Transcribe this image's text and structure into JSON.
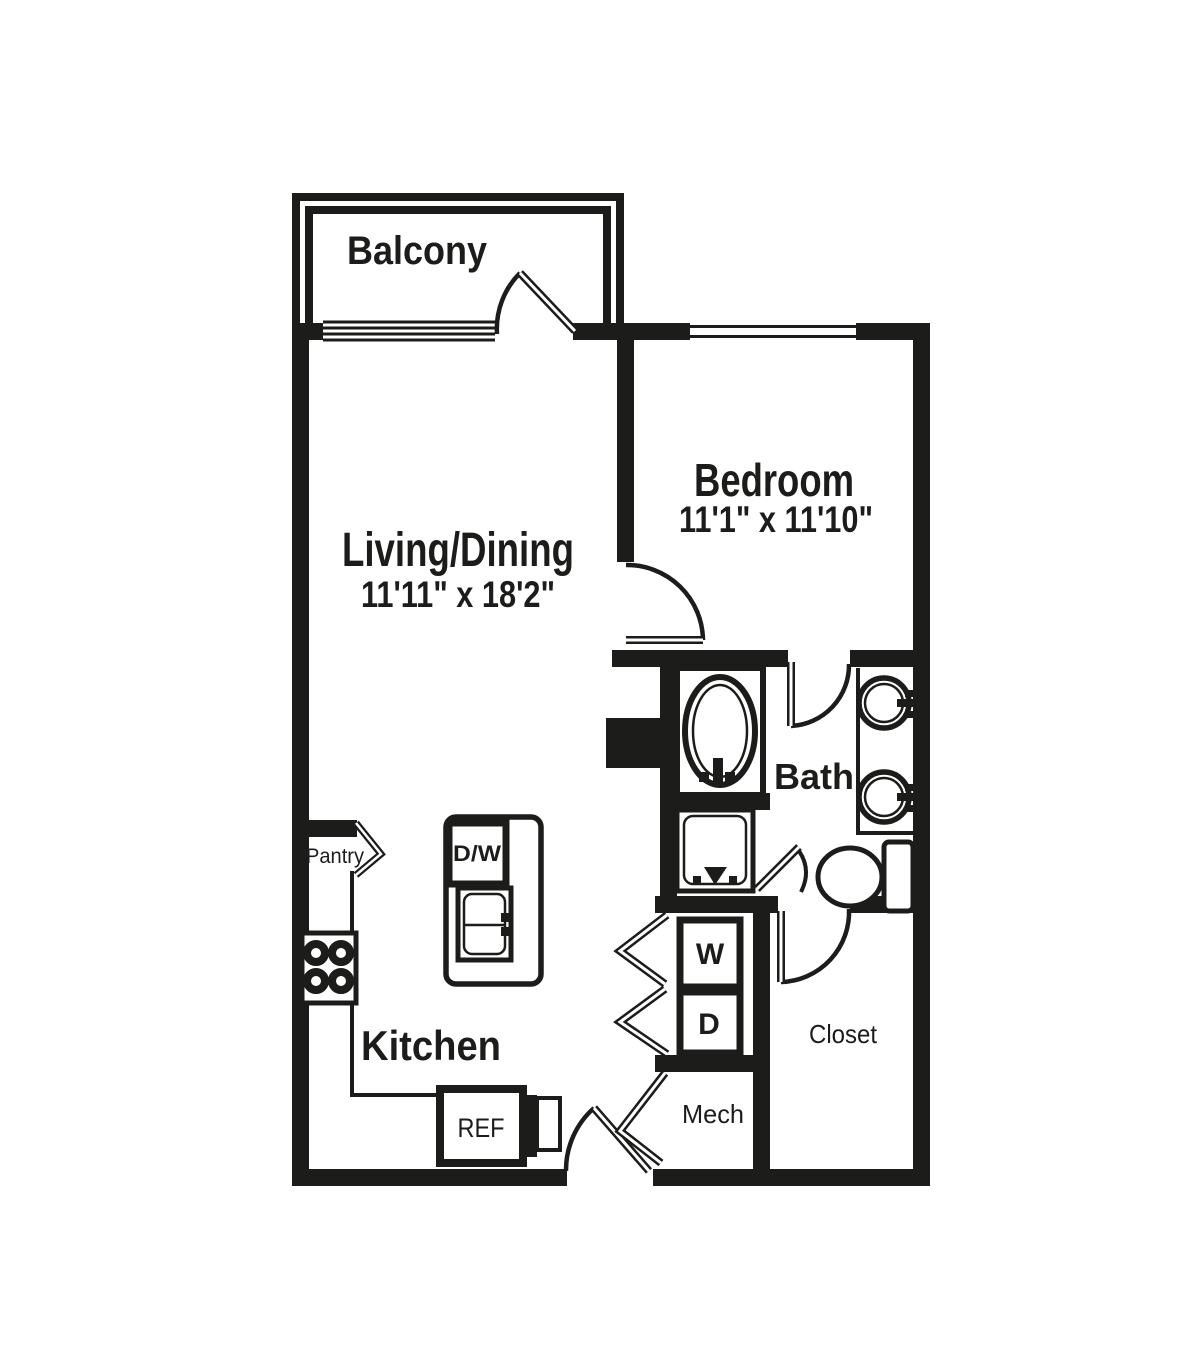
{
  "plan": {
    "rooms": {
      "balcony": {
        "label": "Balcony"
      },
      "living_dining": {
        "label": "Living/Dining",
        "dimensions": "11'11\" x 18'2\""
      },
      "bedroom": {
        "label": "Bedroom",
        "dimensions": "11'1\" x 11'10\""
      },
      "bath": {
        "label": "Bath"
      },
      "kitchen": {
        "label": "Kitchen"
      },
      "pantry": {
        "label": "Pantry"
      },
      "closet": {
        "label": "Closet"
      },
      "mech": {
        "label": "Mech"
      }
    },
    "appliances": {
      "dishwasher": {
        "label": "D/W"
      },
      "refrigerator": {
        "label": "REF"
      },
      "washer": {
        "label": "W"
      },
      "dryer": {
        "label": "D"
      }
    }
  },
  "colors": {
    "line": "#1c1c1a",
    "background": "#ffffff"
  }
}
